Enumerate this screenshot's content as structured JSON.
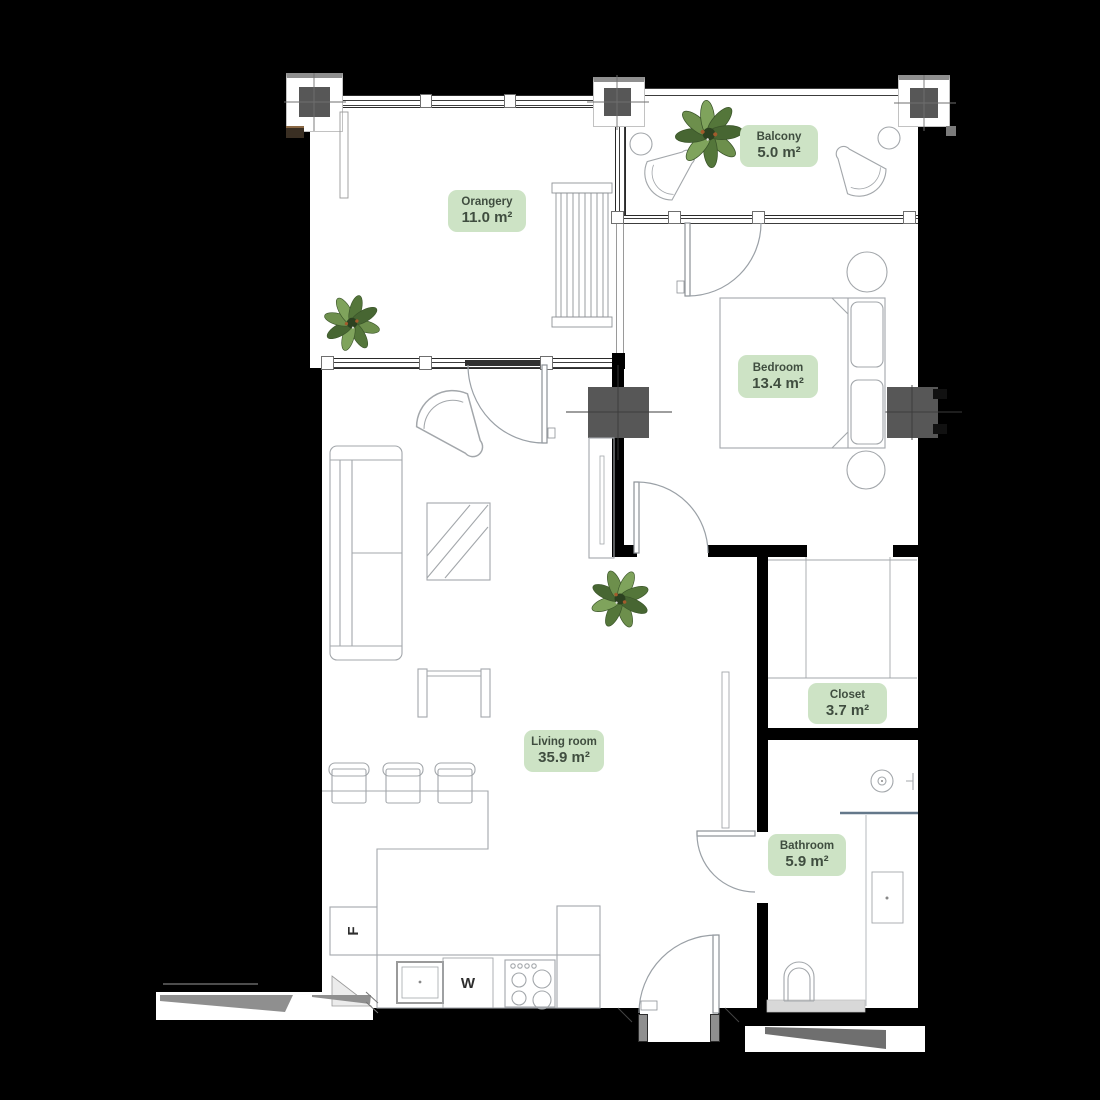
{
  "plan": {
    "rooms": {
      "orangery": {
        "name": "Orangery",
        "area": "11.0 m²"
      },
      "balcony": {
        "name": "Balcony",
        "area": "5.0 m²"
      },
      "bedroom": {
        "name": "Bedroom",
        "area": "13.4 m²"
      },
      "living_room": {
        "name": "Living room",
        "area": "35.9 m²"
      },
      "closet": {
        "name": "Closet",
        "area": "3.7 m²"
      },
      "bathroom": {
        "name": "Bathroom",
        "area": "5.9 m²"
      }
    },
    "appliances": {
      "fridge_label": "F",
      "washer_label": "W"
    },
    "colors": {
      "background": "#000000",
      "floor": "#ffffff",
      "wall": "#000000",
      "pillar": "#575757",
      "label_bg": "#cde3c5",
      "label_text": "#3f4d3f",
      "plant_green": "#6d8f4c"
    }
  }
}
